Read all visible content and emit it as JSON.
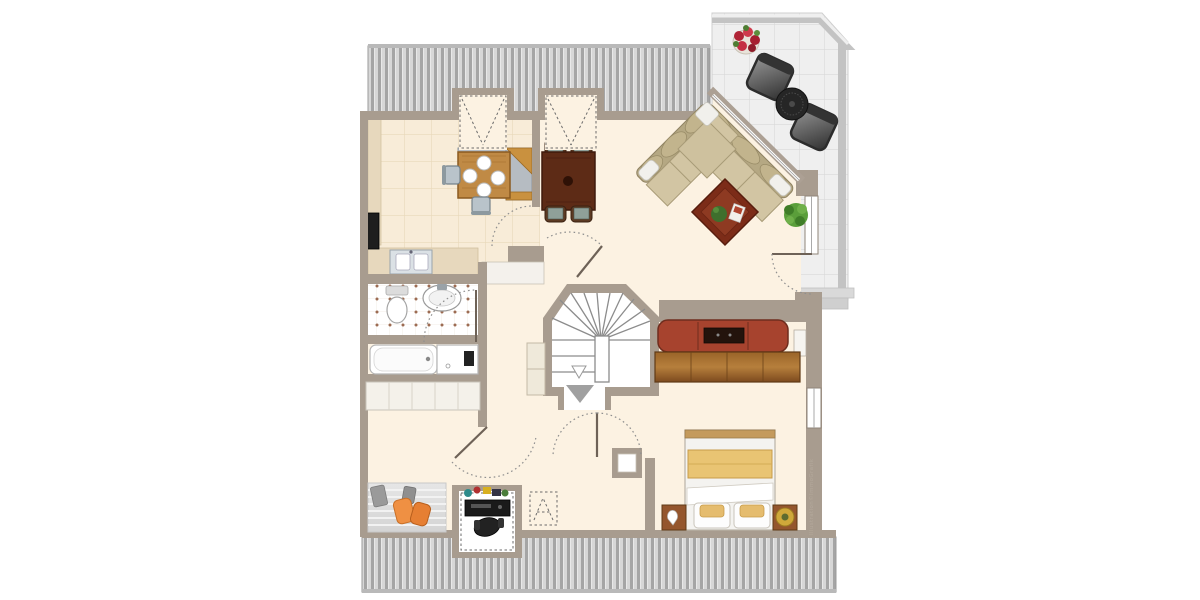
{
  "document": {
    "kind": "floor-plan",
    "description": "attic apartment with sloped-roof hatching, roof terrace, winder staircase"
  },
  "watermark": {
    "text": "Illustration©ImmoGrafik"
  },
  "palette": {
    "background": "#ffffff",
    "floor_cream": "#fcf2e2",
    "kitchen_tile": "#f8ecd8",
    "wall": "#a89c8f",
    "wall_dark": "#7d7265",
    "roof_hatch_light": "#d7d7d7",
    "roof_hatch_dark": "#a5a5a5",
    "balcony_tile": "#efefef",
    "wood": "#b97f3f",
    "dark_wood": "#5d2b16",
    "sofa_red": "#a7432e",
    "sofa_beige": "#d2c5a3",
    "accent_orange": "#ef9043",
    "bed_blanket": "#e9c473"
  },
  "rooms": [
    {
      "id": "kitchen",
      "label": "Kitchen",
      "furniture": [
        "square wood table with 4 plates",
        "2 chairs",
        "L-shaped counter",
        "sink counter",
        "tall dark appliance",
        "roof dormer window"
      ]
    },
    {
      "id": "dining-area",
      "label": "Dining area",
      "furniture": [
        "dark wood table",
        "4 upholstered chairs",
        "roof dormer window"
      ]
    },
    {
      "id": "living-room",
      "label": "Living room",
      "furniture": [
        "beige corner sofa",
        "square coffee table with plant",
        "potted plant",
        "red 3-seat sofa",
        "wood sideboard",
        "wall niche"
      ]
    },
    {
      "id": "balcony",
      "label": "Roof terrace",
      "furniture": [
        "2 metal chairs",
        "round bistro table",
        "red flower pot"
      ]
    },
    {
      "id": "bathroom",
      "label": "Bathroom",
      "furniture": [
        "toilet",
        "washbasin",
        "bathtub",
        "shower",
        "built-in wardrobe"
      ]
    },
    {
      "id": "stair-hall",
      "label": "Hall",
      "furniture": [
        "winder staircase going down",
        "tall cabinet",
        "duct shaft"
      ]
    },
    {
      "id": "bedroom",
      "label": "Bedroom",
      "furniture": [
        "double bed",
        "2 nightstands",
        "bedside lamp",
        "window in gable wall"
      ]
    },
    {
      "id": "home-office",
      "label": "Study corner",
      "furniture": [
        "desk with PC",
        "office chair",
        "striped rug",
        "2 orange floor cushions",
        "roof window marker",
        "desk dormer"
      ]
    }
  ],
  "doors": [
    "kitchen door",
    "bathroom door",
    "entry door at staircase",
    "double-swing hall door",
    "study door",
    "terrace door"
  ]
}
